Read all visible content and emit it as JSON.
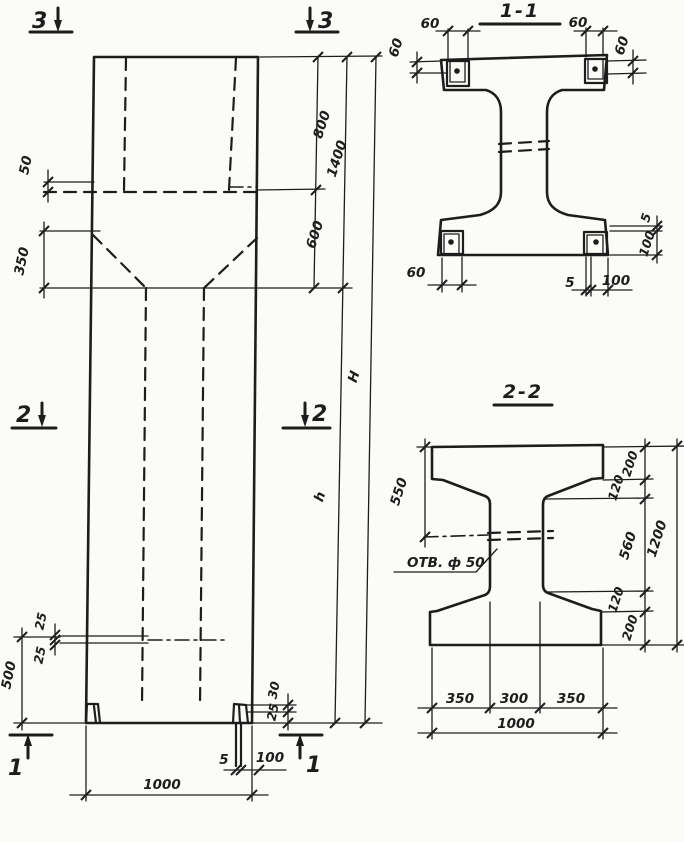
{
  "colors": {
    "ink": "#1d1d1d",
    "paper": "#fbfbf8"
  },
  "elevation": {
    "marks": {
      "m3l": "3",
      "m3r": "3",
      "m2l": "2",
      "m2r": "2",
      "m1l": "1",
      "m1r": "1"
    },
    "dims": {
      "d50": "50",
      "d350": "350",
      "d800": "800",
      "d1400": "1400",
      "d600": "600",
      "dH": "H",
      "dh": "h",
      "d500": "500",
      "d25a": "25",
      "d25b": "25",
      "d30": "30",
      "d25c": "25",
      "d5": "5",
      "d100": "100",
      "d1000": "1000"
    }
  },
  "section11": {
    "title": "1-1",
    "dims": {
      "tl60": "60",
      "tlv60": "60",
      "tr60": "60",
      "trv60": "60",
      "bl60": "60",
      "b5": "5",
      "b100": "100",
      "r5": "5",
      "r100": "100"
    }
  },
  "section22": {
    "title": "2-2",
    "dims": {
      "d550": "550",
      "hole": "ОТВ. ф 50",
      "r200t": "200",
      "r120t": "120",
      "r560": "560",
      "r120b": "120",
      "r200b": "200",
      "r1200": "1200",
      "b350l": "350",
      "b300": "300",
      "b350r": "350",
      "b1000": "1000"
    }
  }
}
